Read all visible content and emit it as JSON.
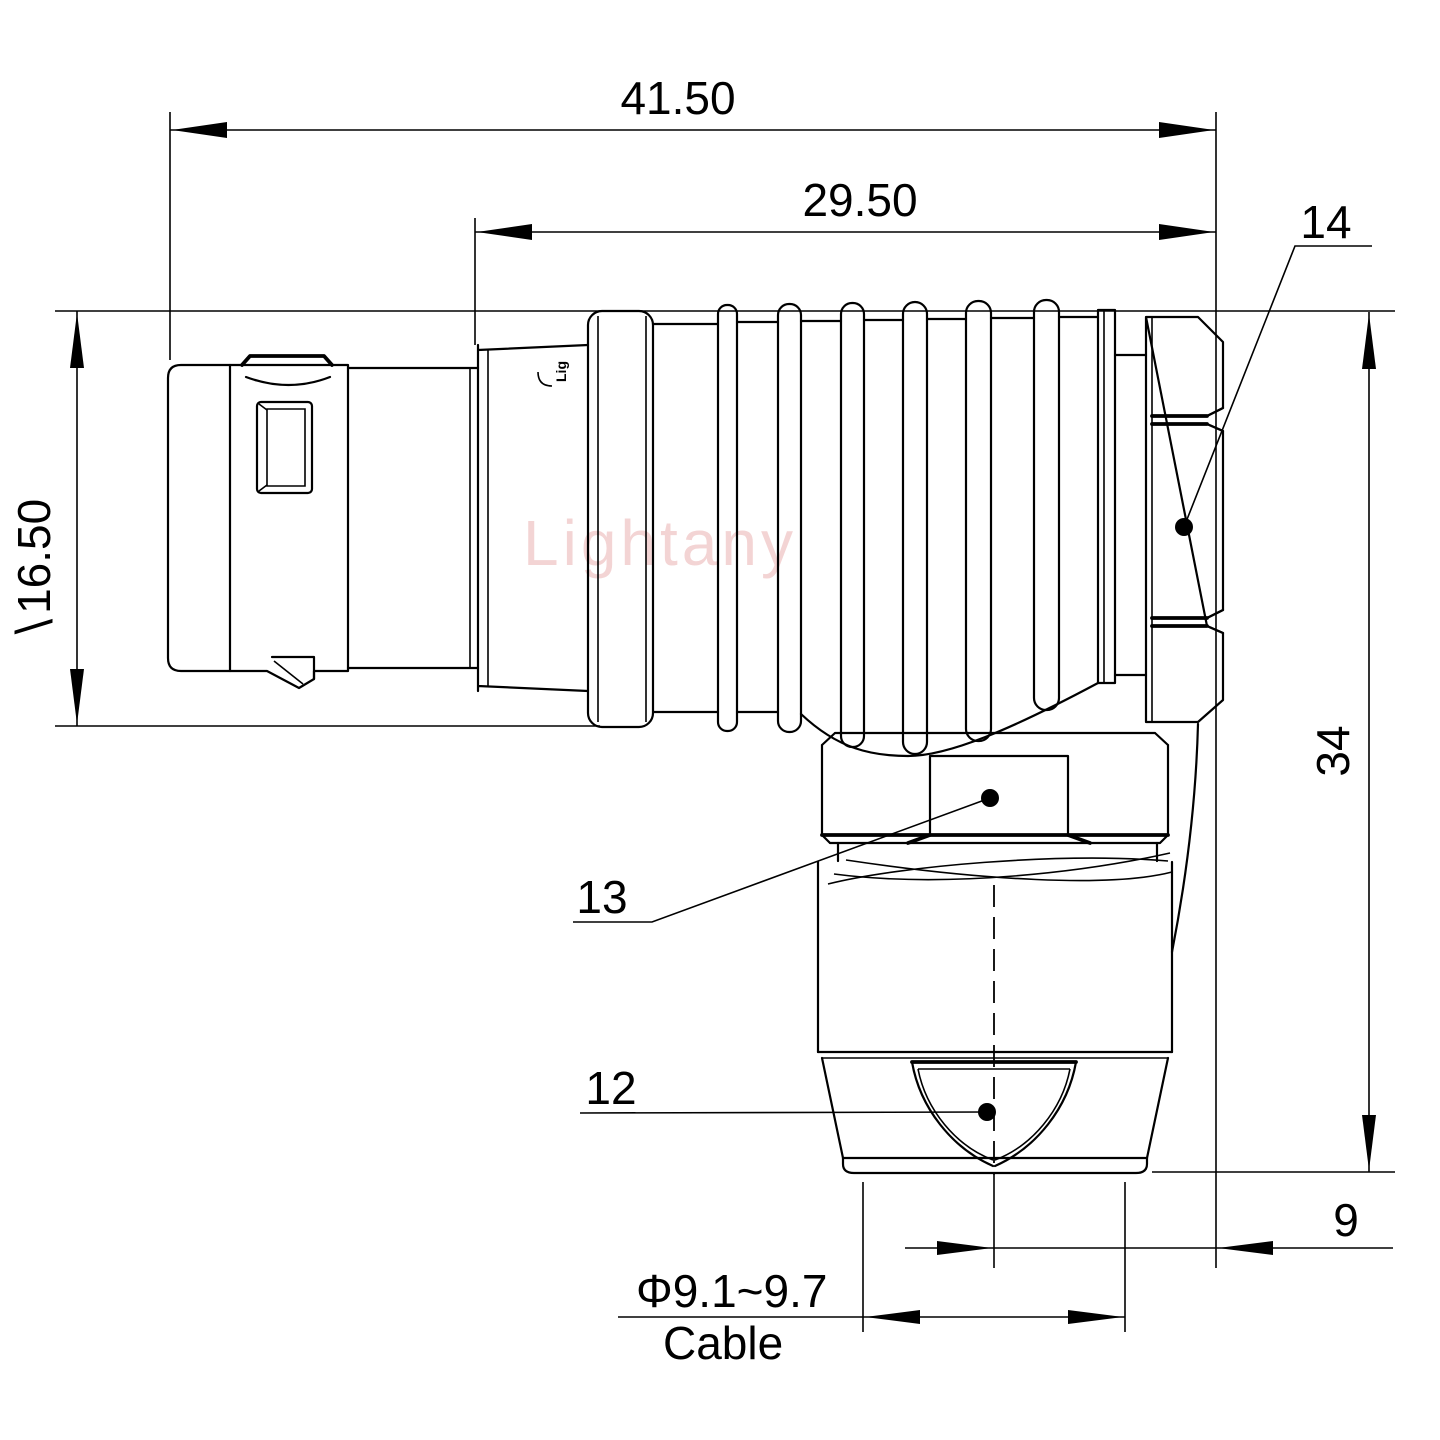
{
  "drawing": {
    "type": "engineering-dimension-drawing",
    "watermark": "Lightany",
    "part_marking": "Lig",
    "dimensions": {
      "total_length": "41.50",
      "plug_length": "29.50",
      "body_diameter": "∖16.50",
      "overall_height": "34",
      "axis_offset": "9",
      "cable_diameter": "Φ9.1~9.7",
      "cable_label": "Cable"
    },
    "callouts": {
      "coupling_nut": "14",
      "back_nut": "13",
      "cable_bush": "12"
    },
    "colors": {
      "line": "#000000",
      "background": "#ffffff",
      "watermark": "#e49a9a"
    }
  }
}
